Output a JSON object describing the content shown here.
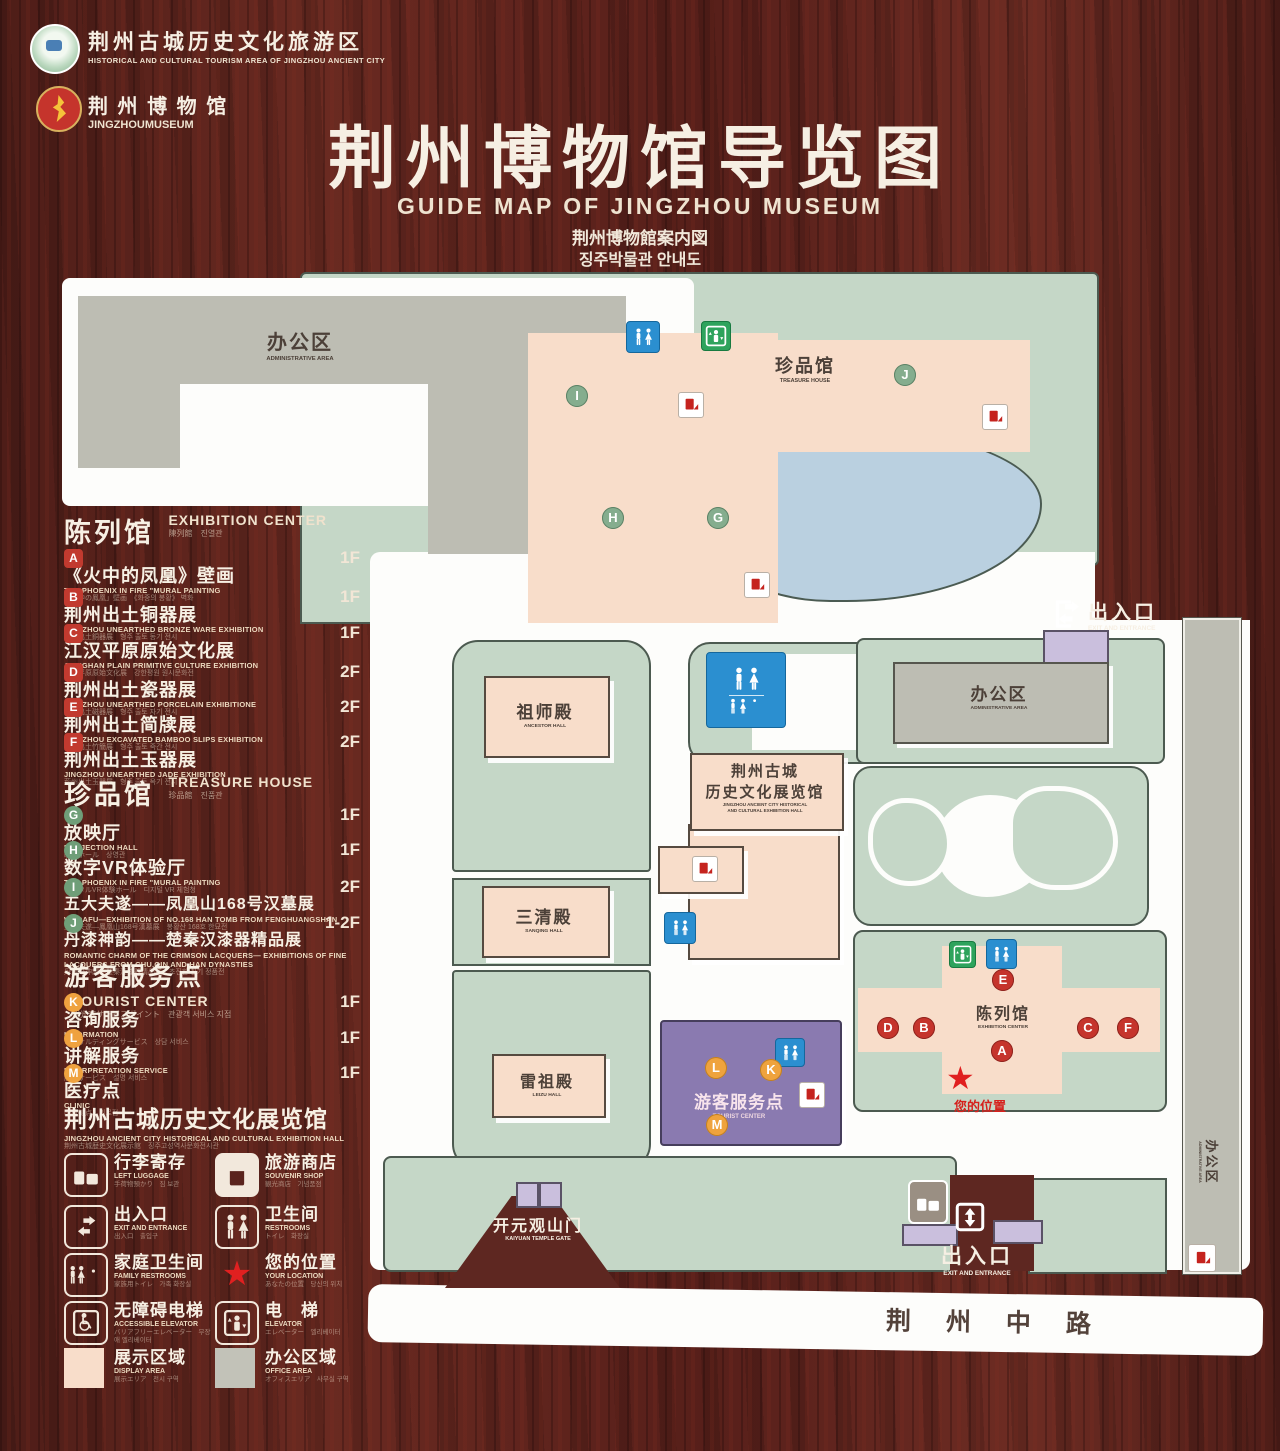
{
  "header": {
    "logo1": {
      "line1": "荆州古城历史文化旅游区",
      "line2": "HISTORICAL AND CULTURAL TOURISM AREA OF JINGZHOU ANCIENT CITY"
    },
    "logo2": {
      "line1": "荆 州 博 物 馆",
      "line2": "JINGZHOUMUSEUM"
    },
    "title": "荆州博物馆导览图",
    "subtitle_en": "GUIDE MAP OF JINGZHOU MUSEUM",
    "subtitle_ja": "荆州博物館案内図",
    "subtitle_ko": "징주박물관 안내도"
  },
  "legend": {
    "sections": [
      {
        "zh": "陈列馆",
        "en": "EXHIBITION CENTER",
        "sub": "陳列館　진열관",
        "items": [
          {
            "letter": "A",
            "zh": "《火中的凤凰》壁画",
            "en": "THE PHOENIX IN FIRE \"MURAL PAINTING",
            "sub": "「火中の鳳凰」壁画　《화중의 봉황》 벽화",
            "floor": "1F"
          },
          {
            "letter": "B",
            "zh": "荆州出土铜器展",
            "en": "JINGZHOU UNEARTHED BRONZE WARE EXHIBITION",
            "sub": "荊州出土銅器展　형주 출토 동기 전시",
            "floor": "1F"
          },
          {
            "letter": "C",
            "zh": "江汉平原原始文化展",
            "en": "JIANGHAN PLAIN PRIMITIVE CULTURE EXHIBITION",
            "sub": "江漢平原原始文化展　강한평원 원시문화전",
            "floor": "1F"
          },
          {
            "letter": "D",
            "zh": "荆州出土瓷器展",
            "en": "JINGZHOU UNEARTHED PORCELAIN EXHIBITIONE",
            "sub": "荊州出土磁器展　형주 출토 자기 전시",
            "floor": "2F"
          },
          {
            "letter": "E",
            "zh": "荆州出土简牍展",
            "en": "JINGZHOU EXCAVATED BAMBOO SLIPS EXHIBITION",
            "sub": "荊州出土竹簡展　형주 출토 죽간 전시",
            "floor": "2F"
          },
          {
            "letter": "F",
            "zh": "荆州出土玉器展",
            "en": "JINGZHOU UNEARTHED JADE EXHIBITION",
            "sub": "荊州出土玉器展　형주 출토 옥기 전시",
            "floor": "2F"
          }
        ]
      },
      {
        "zh": "珍品馆",
        "en": "TREASURE HOUSE",
        "sub": "珍品館　진품관",
        "items": [
          {
            "letter": "G",
            "zh": "放映厅",
            "en": "PROJECTION HALL",
            "sub": "映写ホール　상영관",
            "floor": "1F"
          },
          {
            "letter": "H",
            "zh": "数字VR体验厅",
            "en": "THE PHOENIX IN FIRE \"MURAL PAINTING",
            "sub": "デジタルVR体験ホール　디지털 VR 체험청",
            "floor": "1F"
          },
          {
            "letter": "I",
            "zh": "五大夫遂——凤凰山168号汉墓展",
            "en": "WUDAFU—EXHIBITION OF NO.168 HAN TOMB FROM FENGHUANGSHAN",
            "sub": "五大夫遂—鳳凰山168号漢墓展　봉황산 168호 한묘전",
            "floor": "2F"
          },
          {
            "letter": "J",
            "zh": "丹漆神韵——楚秦汉漆器精品展",
            "en": "ROMANTIC CHARM OF THE CRIMSON LACQUERS— EXHIBITIONS OF FINE LACQUERS FROM CHU,QIN AND HAN DYNASTIES",
            "sub": "丹漆の神韻—楚秦漢漆器精品展　초진한 칠기 정품전",
            "floor": "1-2F"
          }
        ]
      },
      {
        "zh": "游客服务点",
        "en": "TOURIST CENTER",
        "sub": "観光客サービスポイント　관광객 서비스 지점",
        "items": [
          {
            "letter": "K",
            "zh": "咨询服务",
            "en": "INFORMATION",
            "sub": "コンサルティングサービス　상담 서비스",
            "floor": "1F"
          },
          {
            "letter": "L",
            "zh": "讲解服务",
            "en": "INTERPRETATION SERVICE",
            "sub": "解説サービス　설명 서비스",
            "floor": "1F"
          },
          {
            "letter": "M",
            "zh": "医疗点",
            "en": "CLINIC",
            "sub": "医療拠点　의료점",
            "floor": "1F"
          }
        ]
      }
    ],
    "hall_note": {
      "zh": "荆州古城历史文化展览馆",
      "en": "JINGZHOU ANCIENT CITY HISTORICAL AND CULTURAL EXHIBITION HALL",
      "sub": "荆州古城歴史文化展示館　징주고성역사문화전시관"
    },
    "facilities": [
      {
        "zh": "行李寄存",
        "en": "LEFT LUGGAGE",
        "sub": "手荷物預かり　짐 보관"
      },
      {
        "zh": "旅游商店",
        "en": "SOUVENIR SHOP",
        "sub": "観光商店　기념품점"
      },
      {
        "zh": "出入口",
        "en": "EXIT AND ENTRANCE",
        "sub": "出入口　출입구"
      },
      {
        "zh": "卫生间",
        "en": "RESTROOMS",
        "sub": "トイレ　화장실"
      },
      {
        "zh": "家庭卫生间",
        "en": "FAMILY RESTROOMS",
        "sub": "家族用トイレ　가족 화장실"
      },
      {
        "zh": "您的位置",
        "en": "YOUR LOCATION",
        "sub": "あなたの位置　당신의 위치"
      },
      {
        "zh": "无障碍电梯",
        "en": "ACCESSIBLE ELEVATOR",
        "sub": "バリアフリーエレベーター　무장애 엘리베이터"
      },
      {
        "zh": "电　梯",
        "en": "ELEVATOR",
        "sub": "エレベーター　엘리베이터"
      },
      {
        "zh": "展示区域",
        "en": "DISPLAY AREA",
        "sub": "展示エリア　전시 구역"
      },
      {
        "zh": "办公区域",
        "en": "OFFICE AREA",
        "sub": "オフィスエリア　사무실 구역"
      }
    ],
    "colors": {
      "display_area": "#f8ddca",
      "office_area": "#c2c2b8",
      "marker_red": "#c5342c",
      "marker_green": "#85ad8e",
      "marker_orange": "#efa33d"
    }
  },
  "map": {
    "admin_area_top": {
      "zh": "办公区",
      "en": "ADMINISTRATIVE AREA"
    },
    "treasure_house": {
      "zh": "珍品馆",
      "en": "TREASURE HOUSE"
    },
    "ancestor_hall": {
      "zh": "祖师殿",
      "en": "ANCESTOR HALL"
    },
    "sanqing_hall": {
      "zh": "三清殿",
      "en": "SANQING HALL"
    },
    "leizu_hall": {
      "zh": "雷祖殿",
      "en": "LEIZU HALL"
    },
    "exhibition_hall_complex": {
      "zh1": "荆州古城",
      "zh2": "历史文化展览馆",
      "en1": "JINGZHOU ANCIENT CITY HISTORICAL",
      "en2": "AND CULTURAL EXHIBITION HALL"
    },
    "tourist_center": {
      "zh": "游客服务点",
      "en": "TOURIST CENTER"
    },
    "admin_area_right": {
      "zh": "办公区",
      "en": "ADMINISTRATIVE AREA"
    },
    "admin_area_strip": {
      "zh": "办公区",
      "en": "ADMINISTRATIVE AREA"
    },
    "exhibition_center": {
      "zh": "陈列馆",
      "en": "EXHIBITION CENTER"
    },
    "your_location": "您的位置",
    "entrance_top": {
      "zh": "出入口",
      "en": "EXIT AND ENTRANCE"
    },
    "entrance_bottom": {
      "zh": "出入口",
      "en": "EXIT AND ENTRANCE"
    },
    "gate": {
      "zh": "开元观山门",
      "en": "KAIYUAN TEMPLE GATE"
    },
    "road": "荆 州 中 路",
    "marker_letters": {
      "A": "A",
      "B": "B",
      "C": "C",
      "D": "D",
      "E": "E",
      "F": "F",
      "G": "G",
      "H": "H",
      "I": "I",
      "J": "J",
      "K": "K",
      "L": "L",
      "M": "M"
    }
  }
}
